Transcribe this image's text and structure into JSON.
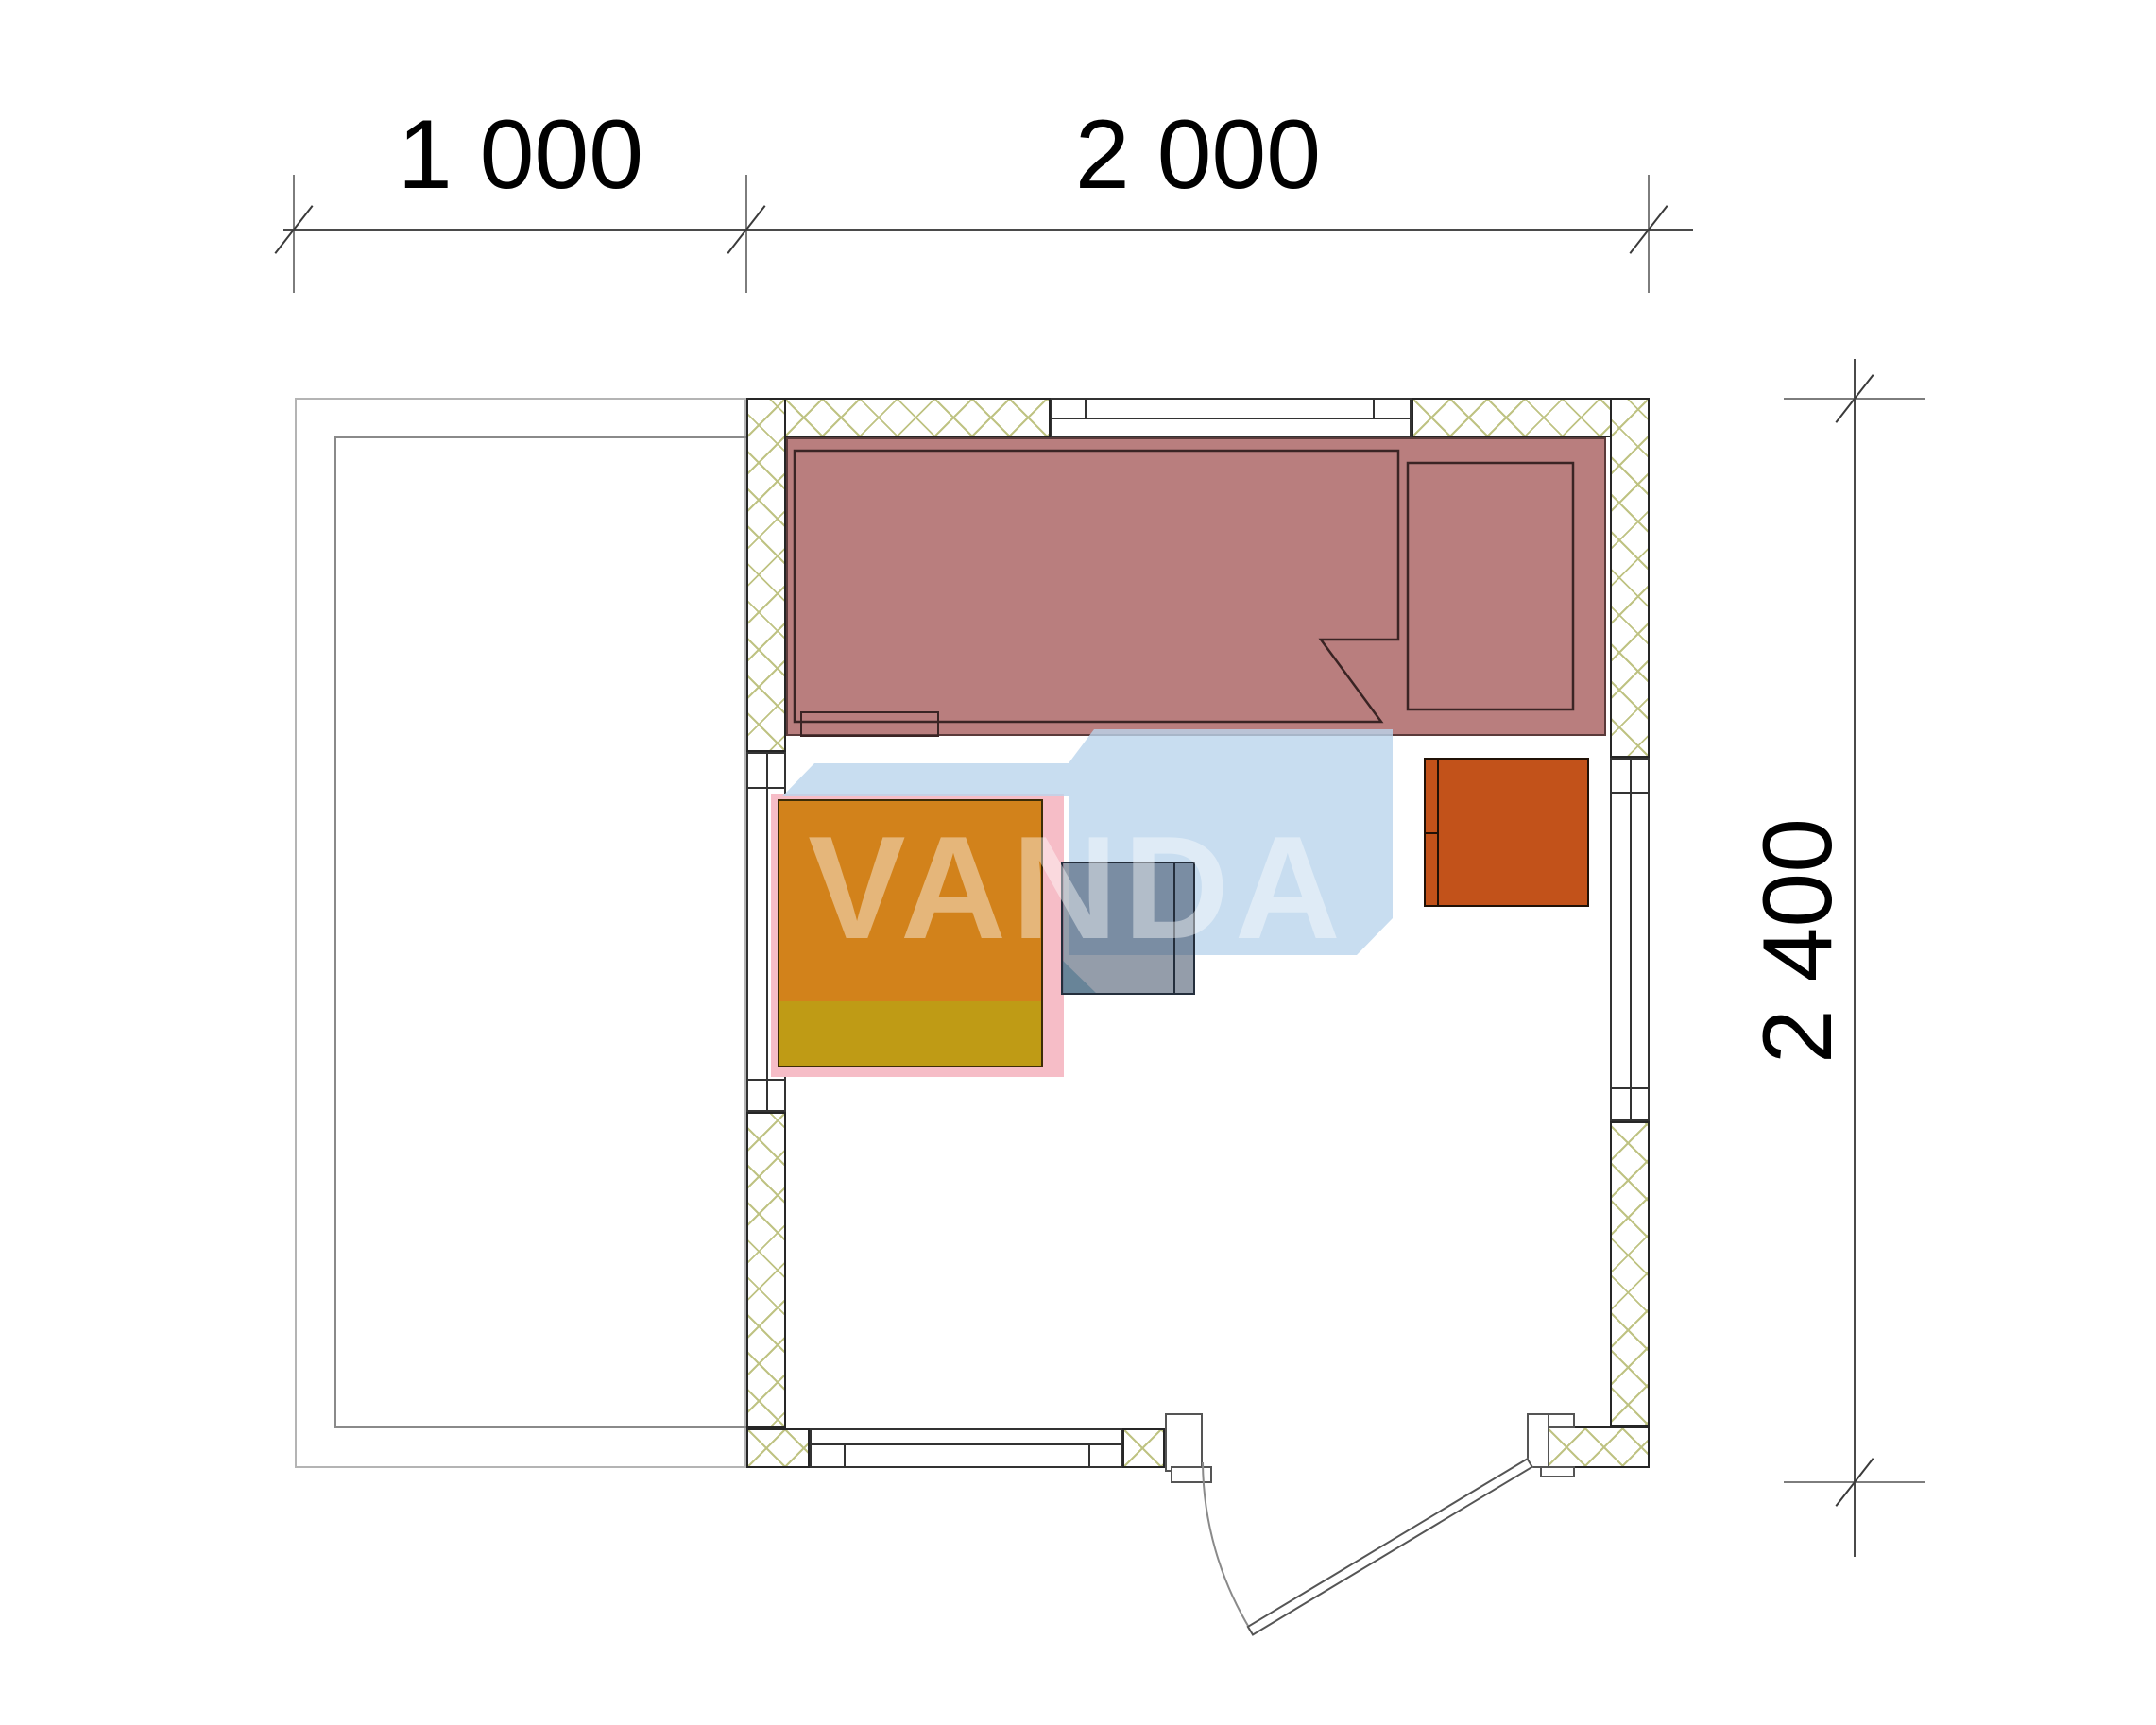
{
  "drawing": {
    "type": "architectural floor plan",
    "dims": {
      "top_labels": [
        "1 000",
        "2 000"
      ],
      "right_label": "2 400"
    },
    "watermark": {
      "text": "VANDA"
    },
    "colors": {
      "wall_hatch_line": "#bfc383",
      "bench_fill": "#b97e7e",
      "bench_border": "#5a3a3a",
      "table_top": "#d2821b",
      "table_bottom": "#bf9b15",
      "cabinet_fill": "#c2521a",
      "stool_fill": "rgba(50,68,92,0.52)",
      "watermark_blue": "rgba(186,212,236,0.8)",
      "watermark_pink": "#f6bdc7",
      "dimension_line": "#4a4a4a"
    }
  }
}
